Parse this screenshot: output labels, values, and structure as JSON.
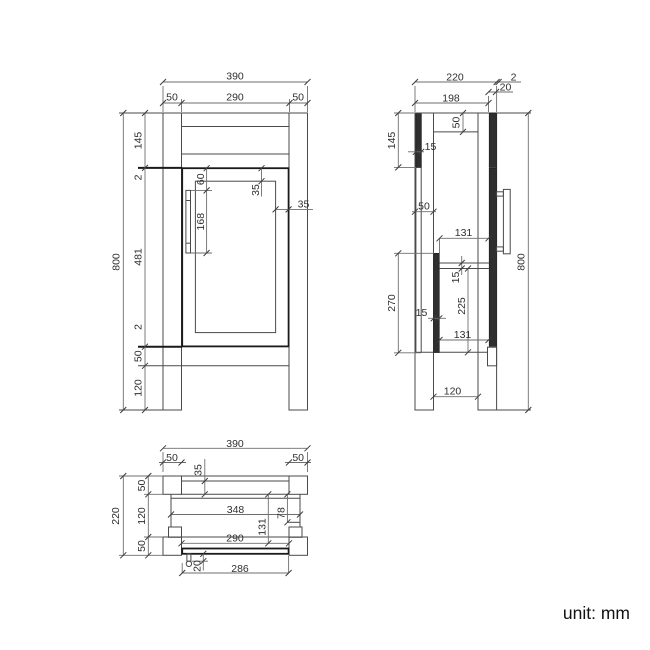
{
  "front": {
    "overall_width": "390",
    "left_leg_width": "50",
    "opening_width": "290",
    "right_leg_width": "50",
    "overall_height": "800",
    "top_band_height": "145",
    "top_gap": "2",
    "door_height": "481",
    "bottom_gap": "2",
    "bottom_rail_height": "50",
    "leg_clearance": "120",
    "handle_top_offset": "60",
    "handle_length": "168",
    "door_top_rail": "35",
    "door_right_stile": "35"
  },
  "side": {
    "overall_depth": "220",
    "body_depth": "198",
    "door_thickness": "20",
    "front_gap": "2",
    "top_band_height": "145",
    "back_panel_thickness": "15",
    "countertop_thickness": "50",
    "leg_depth": "50",
    "upper_shelf_depth": "131",
    "shelf_thickness": "15",
    "niche_opening_height": "225",
    "niche_total_height": "270",
    "divider_thickness": "15",
    "lower_shelf_depth": "131",
    "legs_clear_span": "120",
    "overall_height": "800"
  },
  "plan": {
    "overall_width": "390",
    "left_leg_width": "50",
    "back_rail_depth": "35",
    "right_leg_width": "50",
    "overall_depth": "220",
    "back_leg_depth": "50",
    "legs_clear_depth": "120",
    "front_leg_depth": "50",
    "interior_width": "348",
    "right_notch_depth": "78",
    "interior_depth": "131",
    "opening_width": "290",
    "handle_projection": "20",
    "door_panel_width": "286"
  },
  "note": {
    "unit_label": "unit: mm"
  }
}
